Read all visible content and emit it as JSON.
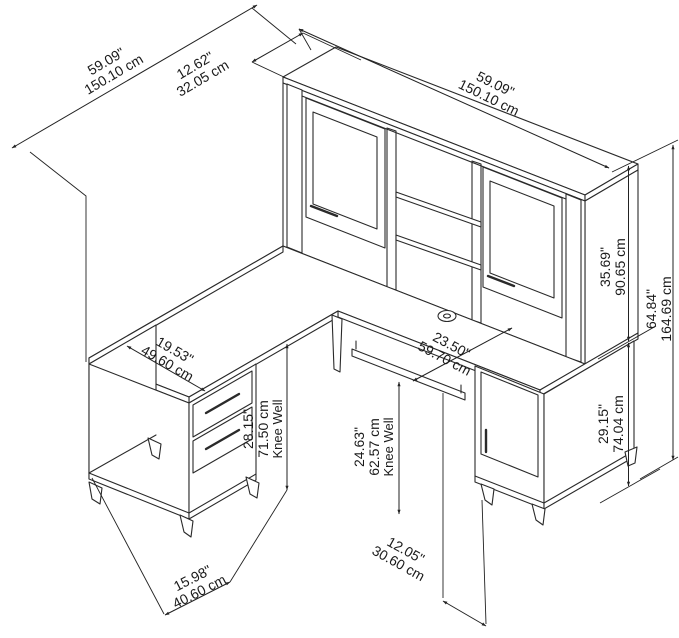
{
  "figure": {
    "kind": "furniture dimension line drawing",
    "subject": "L-shaped desk with hutch, two pedestals, keyboard tray and tapered legs"
  },
  "dims": {
    "overall_depth": {
      "in": "59.09\"",
      "cm": "150.10 cm"
    },
    "hutch_depth": {
      "in": "12.62\"",
      "cm": "32.05 cm"
    },
    "hutch_width": {
      "in": "59.09\"",
      "cm": "150.10 cm"
    },
    "hutch_height": {
      "in": "35.69\"",
      "cm": "90.65 cm"
    },
    "overall_height": {
      "in": "64.84\"",
      "cm": "164.69 cm"
    },
    "return_surface_width": {
      "in": "19.53\"",
      "cm": "49.60 cm"
    },
    "desk_surface_depth": {
      "in": "23.50\"",
      "cm": "59.70 cm"
    },
    "left_knee_well": {
      "in": "28.15\"",
      "cm": "71.50 cm",
      "note": "Knee Well"
    },
    "center_knee_well": {
      "in": "24.63\"",
      "cm": "62.57 cm",
      "note": "Knee Well"
    },
    "desk_height": {
      "in": "29.15\"",
      "cm": "74.04 cm"
    },
    "left_pedestal_depth": {
      "in": "15.98\"",
      "cm": "40.60 cm"
    },
    "knee_well_width": {
      "in": "12.05\"",
      "cm": "30.60 cm"
    }
  }
}
